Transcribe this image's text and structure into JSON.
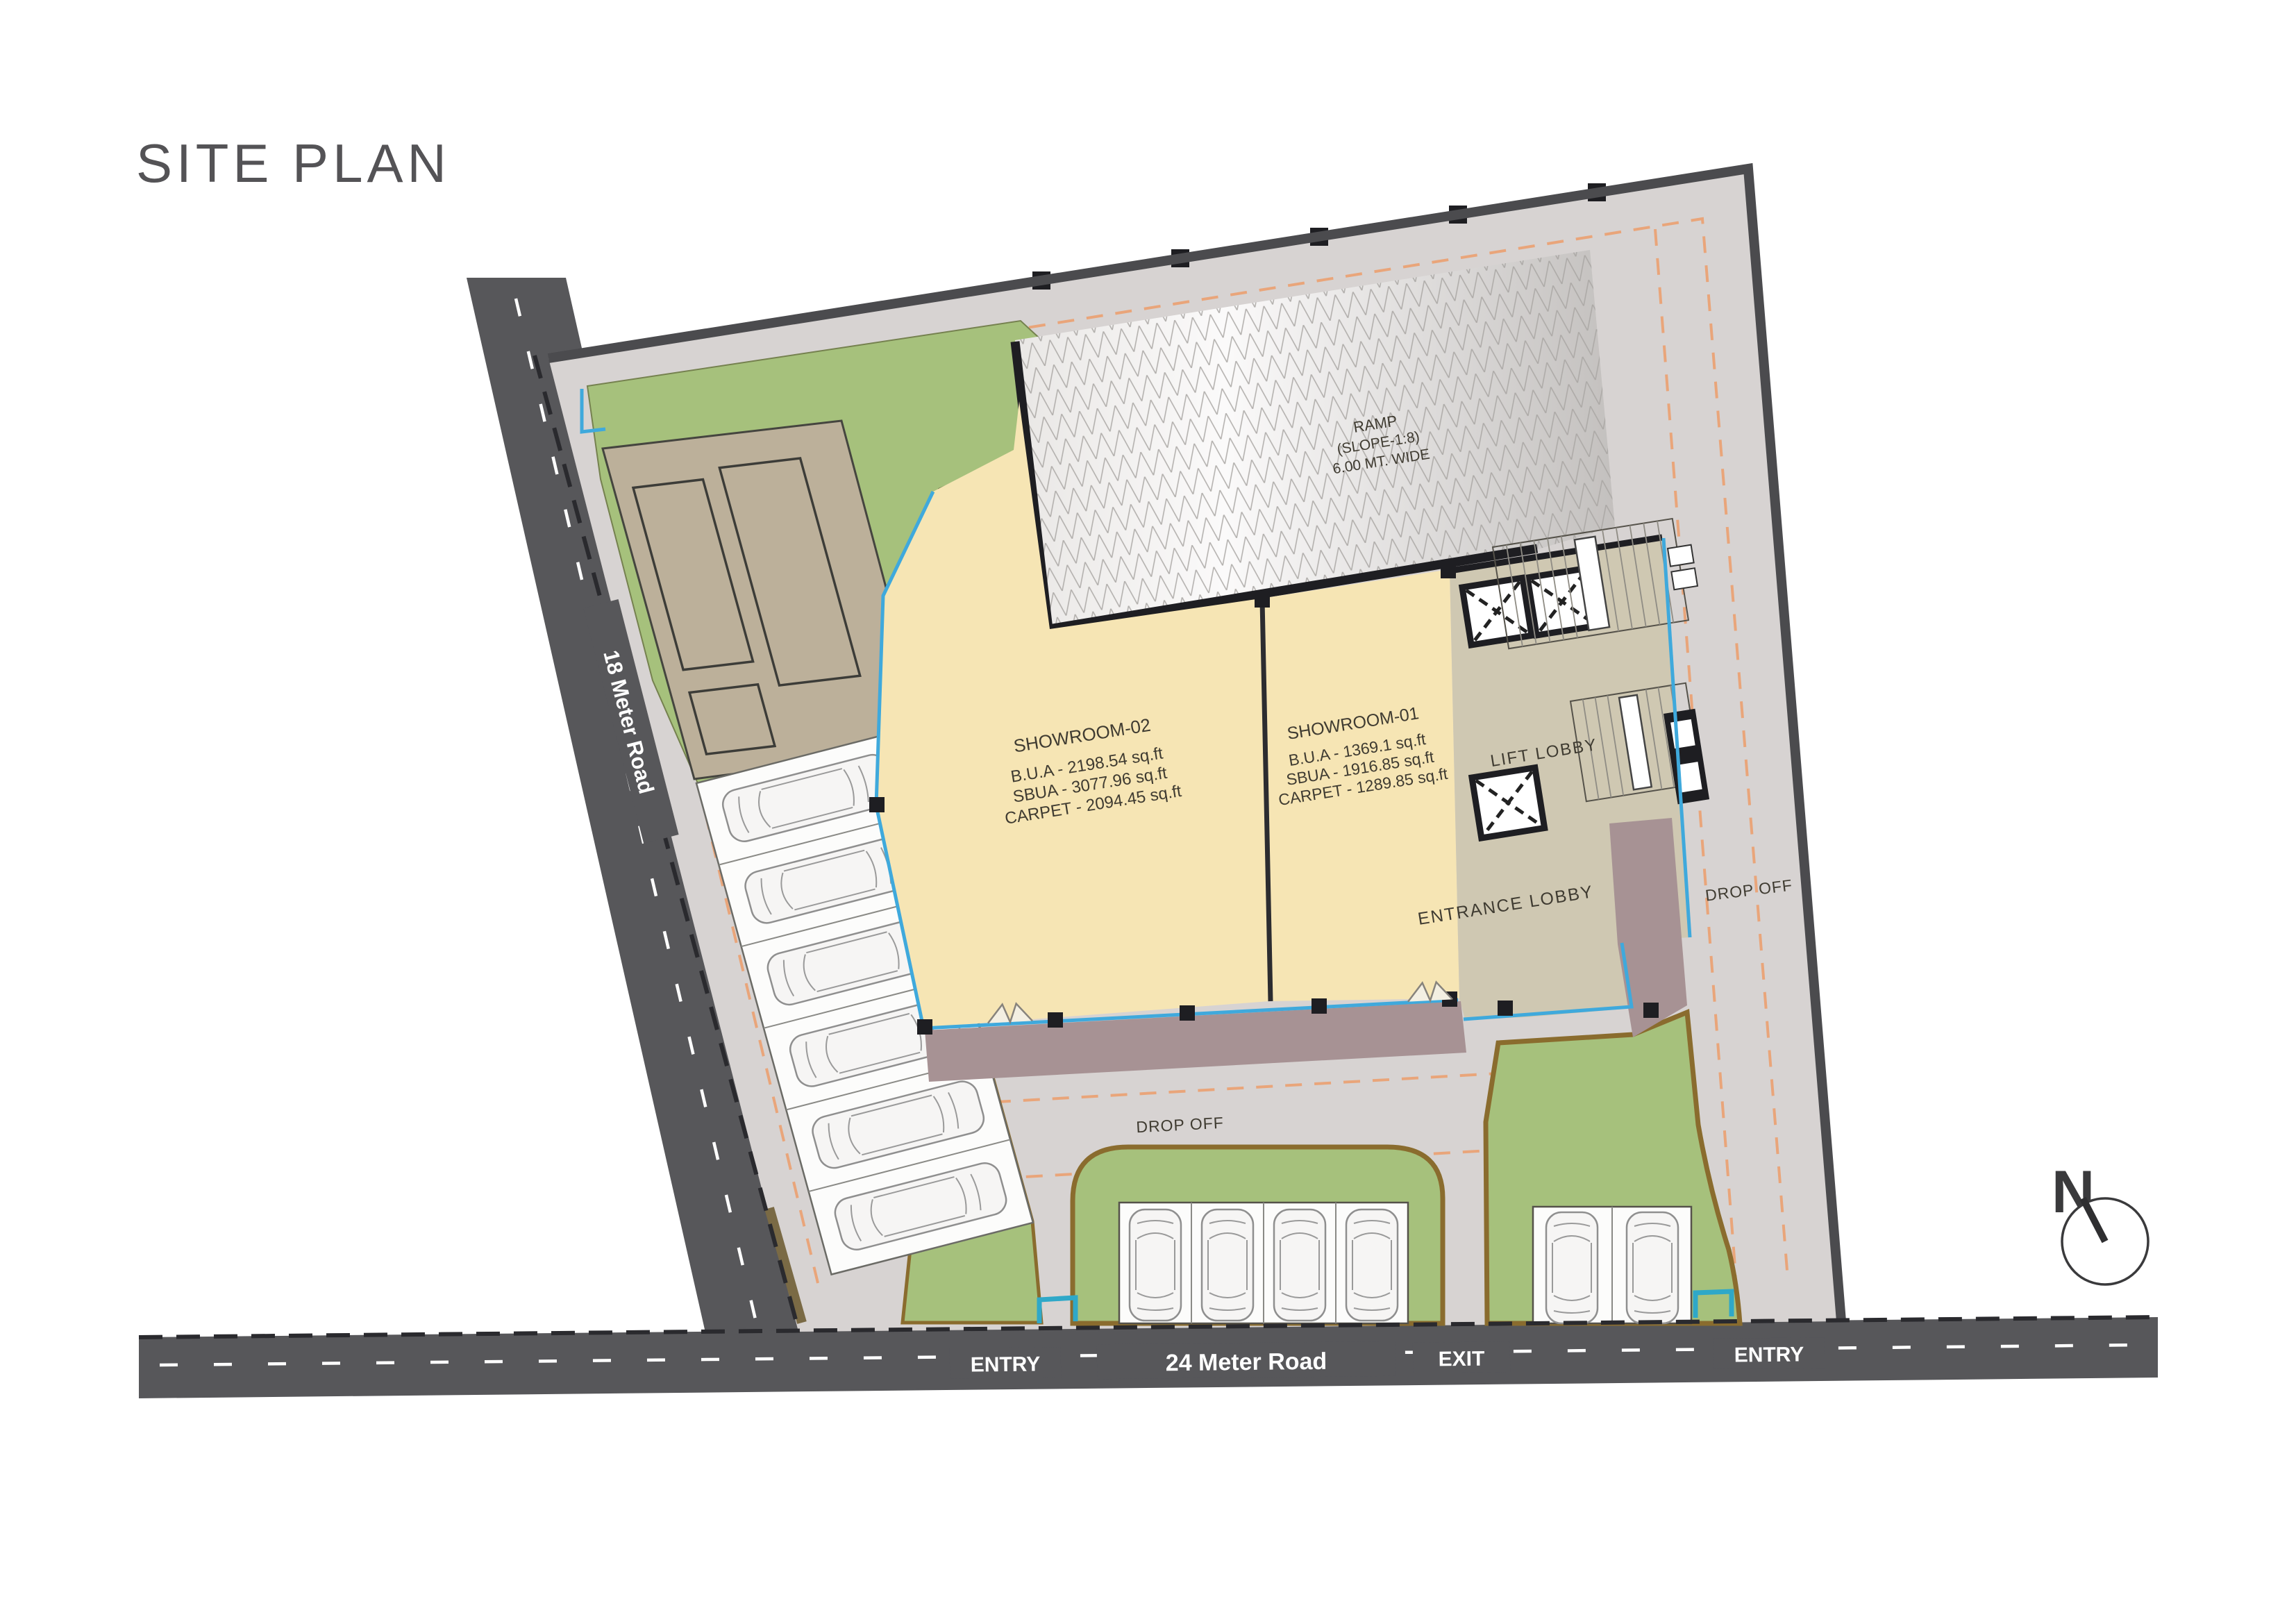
{
  "title": "SITE PLAN",
  "roads": {
    "left_label": "18 Meter Road",
    "bottom_label": "24 Meter Road",
    "entry_left": "ENTRY",
    "exit": "EXIT",
    "entry_right": "ENTRY"
  },
  "ramp": {
    "line1": "RAMP",
    "line2": "(SLOPE-1:8)",
    "line3": "6.00 MT. WIDE"
  },
  "rooms": {
    "lift_lobby": "LIFT LOBBY",
    "entrance_lobby": "ENTRANCE LOBBY"
  },
  "drop_off": {
    "bottom": "DROP OFF",
    "right": "DROP OFF"
  },
  "showrooms": [
    {
      "name": "SHOWROOM-02",
      "bua": "B.U.A - 2198.54 sq.ft",
      "sbua": "SBUA - 3077.96 sq.ft",
      "carpet": "CARPET - 2094.45 sq.ft"
    },
    {
      "name": "SHOWROOM-01",
      "bua": "B.U.A - 1369.1 sq.ft",
      "sbua": "SBUA - 1916.85 sq.ft",
      "carpet": "CARPET - 1289.85 sq.ft"
    }
  ],
  "compass": {
    "north_label": "N"
  },
  "counts": {
    "left_parking_cars": 6,
    "bottom_center_cars": 4,
    "bottom_right_cars": 2
  },
  "colors": {
    "road": "#57575A",
    "pavement": "#D7D3D2",
    "landscape": "#A6C17C",
    "landscape_border": "#8A6C2E",
    "showroom_fill": "#F6E5B4",
    "core_fill": "#CFC8B2",
    "walkway": "#A79294",
    "service_yard": "#BCB09A",
    "setback_line": "#3FA9DC",
    "drive_path": "#E9A57A",
    "wall": "#1E1E22"
  }
}
